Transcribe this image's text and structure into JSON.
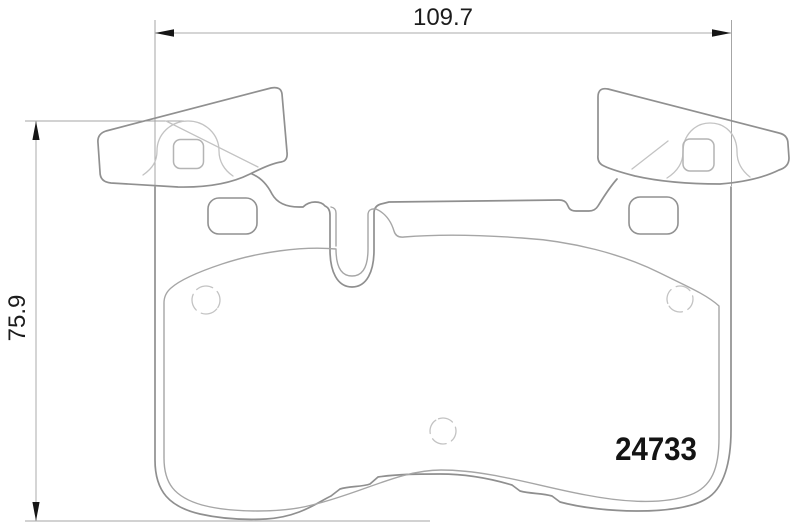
{
  "drawing": {
    "type": "brake-pad-technical-drawing",
    "part_number": "24733",
    "dimensions": {
      "width": "109.7",
      "height": "75.9"
    },
    "colors": {
      "background": "#ffffff",
      "backplate_outline": "#8f8f8f",
      "friction_outline": "#a6a6a6",
      "phantom_line": "#c3c3c3",
      "dimension_line": "#ababab",
      "arrow": "#161616",
      "label_text": "#1c1c1c"
    }
  }
}
